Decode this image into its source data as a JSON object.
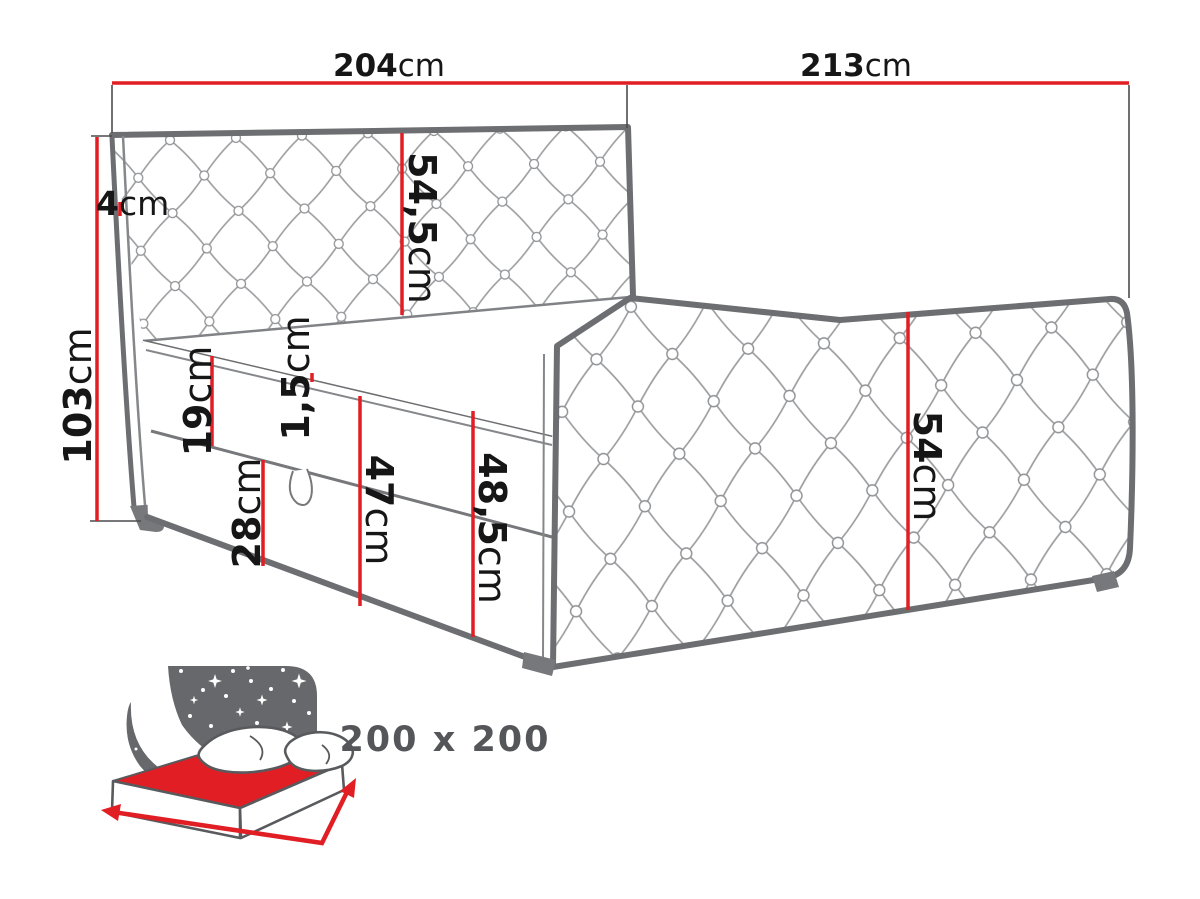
{
  "diagram_labels": {
    "dim_204": {
      "num": "204",
      "unit": "cm"
    },
    "dim_213": {
      "num": "213",
      "unit": "cm"
    },
    "dim_4": {
      "num": "4",
      "unit": "cm"
    },
    "dim_103": {
      "num": "103",
      "unit": "cm"
    },
    "dim_54_5": {
      "num": "54,5",
      "unit": "cm"
    },
    "dim_19": {
      "num": "19",
      "unit": "cm"
    },
    "dim_1_5": {
      "num": "1,5",
      "unit": "cm"
    },
    "dim_28": {
      "num": "28",
      "unit": "cm"
    },
    "dim_47": {
      "num": "47",
      "unit": "cm"
    },
    "dim_48_5": {
      "num": "48,5",
      "unit": "cm"
    },
    "dim_54": {
      "num": "54",
      "unit": "cm"
    }
  },
  "size_badge": {
    "text": "200 x 200"
  },
  "colors": {
    "dimension_red": "#e01e24",
    "bed_outline_gray": "#6d6e71",
    "tufting_gray": "#9b9da0",
    "label_black": "#161616",
    "icon_gray": "#67686b",
    "size_text_gray": "#55565a",
    "background": "#ffffff"
  }
}
